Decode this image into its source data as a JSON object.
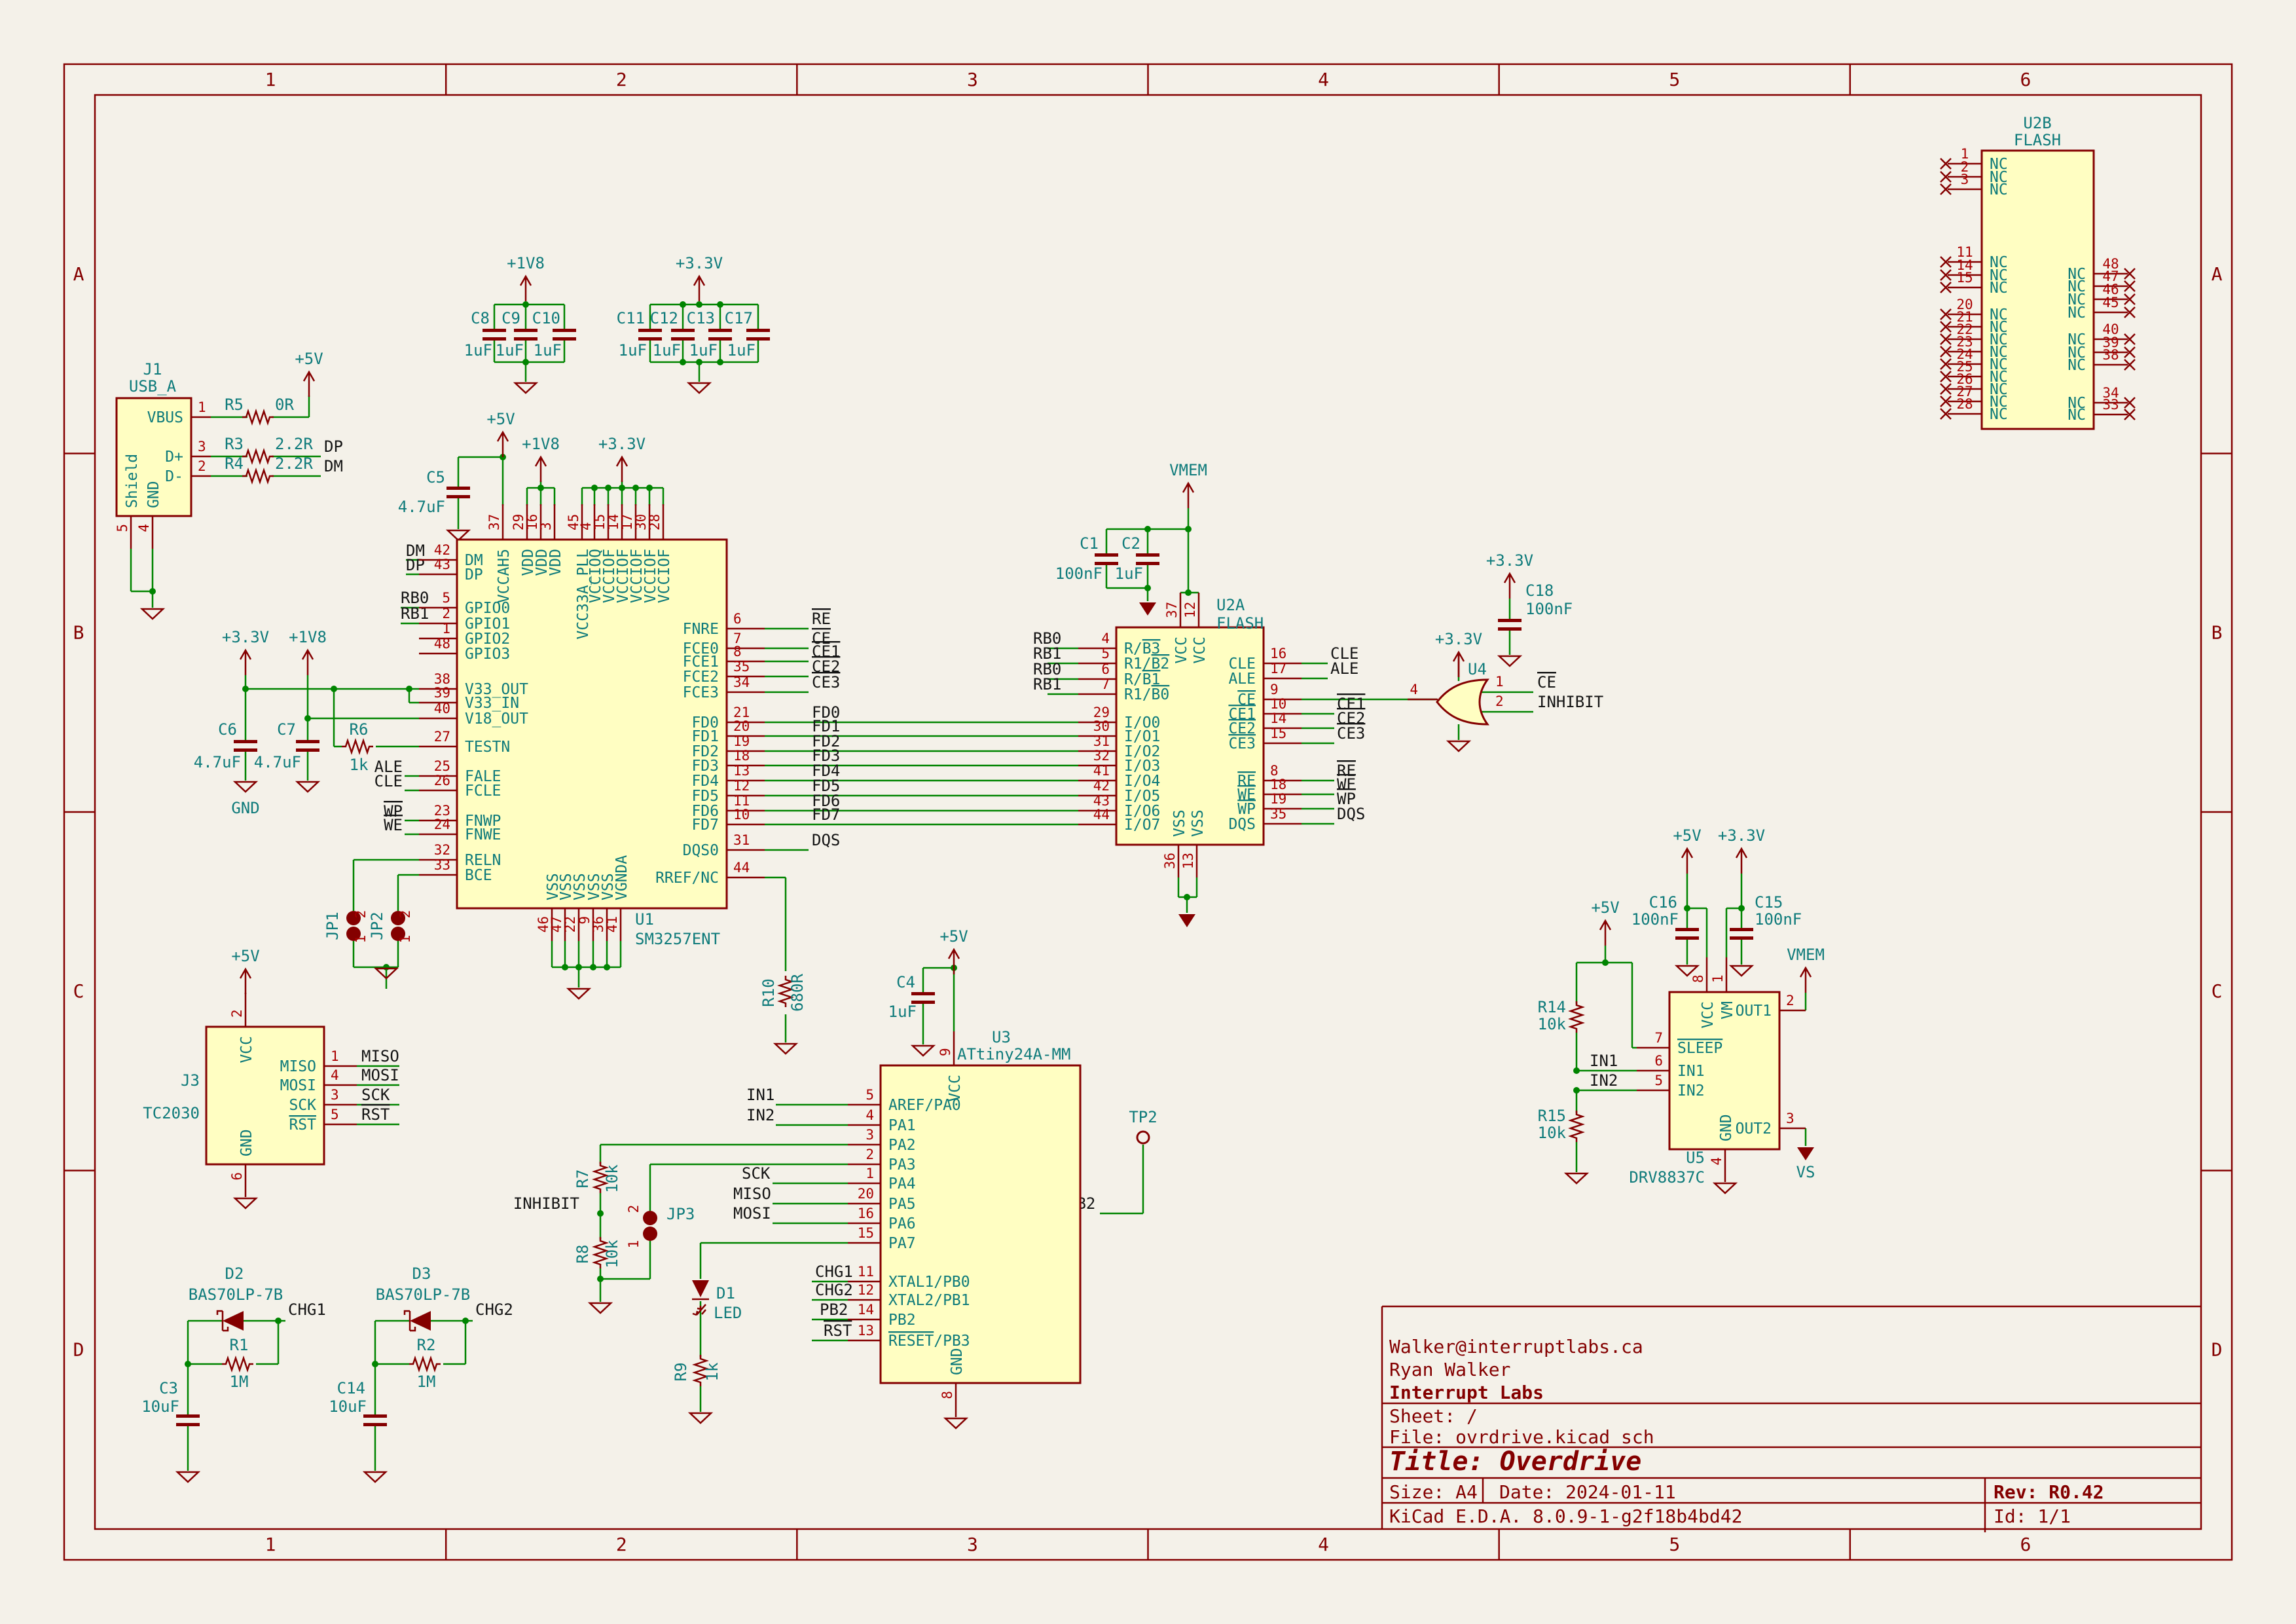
{
  "sheet": {
    "cols": [
      "1",
      "2",
      "3",
      "4",
      "5",
      "6"
    ],
    "rows": [
      "A",
      "B",
      "C",
      "D"
    ]
  },
  "title_block": {
    "email": "Walker@interruptlabs.ca",
    "author": "Ryan Walker",
    "company": "Interrupt Labs",
    "sheet_label": "Sheet: /",
    "file_label": "File: ovrdrive.kicad_sch",
    "title_label": "Title: Overdrive",
    "size_label": "Size: A4",
    "date_label": "Date: 2024-01-11",
    "tool_label": "KiCad E.D.A. 8.0.9-1-g2f18b4bd42",
    "rev_label": "Rev: R0.42",
    "id_label": "Id: 1/1"
  },
  "power": {
    "p5v": "+5V",
    "p1v8": "+1V8",
    "p3v3": "+3.3V",
    "vmem": "VMEM",
    "vs": "VS",
    "gnd": "GND"
  },
  "nets": {
    "dp": "DP",
    "dm": "DM",
    "rb0": "RB0",
    "rb1": "RB1",
    "ale": "ALE",
    "cle": "CLE",
    "wp": "WP",
    "we": "WE",
    "re": "RE",
    "ce": "CE",
    "ce1": "CE1",
    "ce2": "CE2",
    "ce3": "CE3",
    "fd0": "FD0",
    "fd1": "FD1",
    "fd2": "FD2",
    "fd3": "FD3",
    "fd4": "FD4",
    "fd5": "FD5",
    "fd6": "FD6",
    "fd7": "FD7",
    "dqs": "DQS",
    "inhibit": "INHIBIT",
    "in1": "IN1",
    "in2": "IN2",
    "sck": "SCK",
    "miso": "MISO",
    "mosi": "MOSI",
    "rst": "RST",
    "chg1": "CHG1",
    "chg2": "CHG2",
    "pb2": "PB2"
  },
  "components": {
    "U1": {
      "ref": "U1",
      "value": "SM3257ENT",
      "left": [
        [
          "42",
          "DM"
        ],
        [
          "43",
          "DP"
        ],
        [
          "5",
          "GPIO0"
        ],
        [
          "2",
          "GPIO1"
        ],
        [
          "1",
          "GPIO2"
        ],
        [
          "48",
          "GPIO3"
        ],
        [
          "38",
          "V33_OUT"
        ],
        [
          "39",
          "V33_IN"
        ],
        [
          "40",
          "V18_OUT"
        ],
        [
          "27",
          "TESTN"
        ],
        [
          "25",
          "FALE"
        ],
        [
          "26",
          "FCLE"
        ],
        [
          "23",
          "FNWP"
        ],
        [
          "24",
          "FNWE"
        ],
        [
          "32",
          "RELN"
        ],
        [
          "33",
          "BCE"
        ]
      ],
      "right": [
        [
          "6",
          "FNRE"
        ],
        [
          "7",
          "FCE0"
        ],
        [
          "8",
          "FCE1"
        ],
        [
          "35",
          "FCE2"
        ],
        [
          "34",
          "FCE3"
        ],
        [
          "21",
          "FD0"
        ],
        [
          "20",
          "FD1"
        ],
        [
          "19",
          "FD2"
        ],
        [
          "18",
          "FD3"
        ],
        [
          "13",
          "FD4"
        ],
        [
          "12",
          "FD5"
        ],
        [
          "11",
          "FD6"
        ],
        [
          "10",
          "FD7"
        ],
        [
          "31",
          "DQS0"
        ],
        [
          "44",
          "RREF/NC"
        ]
      ],
      "top": [
        [
          "37",
          "VCCAH5"
        ],
        [
          "29",
          "VDD"
        ],
        [
          "16",
          "VDD"
        ],
        [
          "3",
          "VDD"
        ],
        [
          "45",
          "VCC33A_PLL"
        ],
        [
          "4",
          "VCCIOQ"
        ],
        [
          "15",
          "VCCIOF"
        ],
        [
          "14",
          "VCCIOF"
        ],
        [
          "17",
          "VCCIOF"
        ],
        [
          "30",
          "VCCIOF"
        ],
        [
          "28",
          "VCCIOF"
        ]
      ],
      "bottom": [
        [
          "46",
          "VSS"
        ],
        [
          "47",
          "VSS"
        ],
        [
          "22",
          "VSS"
        ],
        [
          "9",
          "VSS"
        ],
        [
          "36",
          "VSS"
        ],
        [
          "41",
          "VGNDA"
        ]
      ]
    },
    "U2A": {
      "ref": "U2A",
      "value": "FLASH",
      "left": [
        [
          "4",
          "R/~B3~"
        ],
        [
          "5",
          "R1/~B2~"
        ],
        [
          "6",
          "R/~B1~"
        ],
        [
          "7",
          "R1/~B0~"
        ],
        [
          "29",
          "I/O0"
        ],
        [
          "30",
          "I/O1"
        ],
        [
          "31",
          "I/O2"
        ],
        [
          "32",
          "I/O3"
        ],
        [
          "41",
          "I/O4"
        ],
        [
          "42",
          "I/O5"
        ],
        [
          "43",
          "I/O6"
        ],
        [
          "44",
          "I/O7"
        ]
      ],
      "right": [
        [
          "16",
          "CLE"
        ],
        [
          "17",
          "ALE"
        ],
        [
          "9",
          "~CE~"
        ],
        [
          "10",
          "~CE1~"
        ],
        [
          "14",
          "~CE2~"
        ],
        [
          "15",
          "~CE3~"
        ],
        [
          "8",
          "~RE~"
        ],
        [
          "18",
          "~WE~"
        ],
        [
          "19",
          "~WP~"
        ],
        [
          "35",
          "DQS"
        ]
      ],
      "top": [
        [
          "37",
          "VCC"
        ],
        [
          "12",
          "VCC"
        ]
      ],
      "bottom": [
        [
          "36",
          "VSS"
        ],
        [
          "13",
          "VSS"
        ]
      ]
    },
    "U2B": {
      "ref": "U2B",
      "value": "FLASH",
      "left": [
        [
          "1",
          "NC"
        ],
        [
          "2",
          "NC"
        ],
        [
          "3",
          "NC"
        ],
        [
          "11",
          "NC"
        ],
        [
          "14",
          "NC"
        ],
        [
          "15",
          "NC"
        ],
        [
          "20",
          "NC"
        ],
        [
          "21",
          "NC"
        ],
        [
          "22",
          "NC"
        ],
        [
          "23",
          "NC"
        ],
        [
          "24",
          "NC"
        ],
        [
          "25",
          "NC"
        ],
        [
          "26",
          "NC"
        ],
        [
          "27",
          "NC"
        ],
        [
          "28",
          "NC"
        ]
      ],
      "right": [
        [
          "48",
          "NC"
        ],
        [
          "47",
          "NC"
        ],
        [
          "46",
          "NC"
        ],
        [
          "45",
          "NC"
        ],
        [
          "40",
          "NC"
        ],
        [
          "39",
          "NC"
        ],
        [
          "38",
          "NC"
        ],
        [
          "34",
          "NC"
        ],
        [
          "33",
          "NC"
        ]
      ]
    },
    "U3": {
      "ref": "U3",
      "value": "ATtiny24A-MM",
      "left": [
        [
          "5",
          "AREF/PA0"
        ],
        [
          "4",
          "PA1"
        ],
        [
          "3",
          "PA2"
        ],
        [
          "2",
          "PA3"
        ],
        [
          "1",
          "PA4"
        ],
        [
          "20",
          "PA5"
        ],
        [
          "16",
          "PA6"
        ],
        [
          "15",
          "PA7"
        ],
        [
          "11",
          "XTAL1/PB0"
        ],
        [
          "12",
          "XTAL2/PB1"
        ],
        [
          "14",
          "PB2"
        ],
        [
          "13",
          "~RESET~/PB3"
        ]
      ],
      "top": [
        [
          "9",
          "VCC"
        ]
      ],
      "bottom": [
        [
          "8",
          "GND"
        ]
      ]
    },
    "U4": {
      "ref": "U4",
      "pins": {
        "out": "4",
        "in1": "1",
        "in2": "2"
      }
    },
    "U5": {
      "ref": "U5",
      "value": "DRV8837C",
      "left": [
        [
          "7",
          "~SLEEP~"
        ],
        [
          "6",
          "IN1"
        ],
        [
          "5",
          "IN2"
        ]
      ],
      "right": [
        [
          "2",
          "OUT1"
        ],
        [
          "3",
          "OUT2"
        ]
      ],
      "top": [
        [
          "8",
          "VCC"
        ],
        [
          "1",
          "VM"
        ]
      ],
      "bottom": [
        [
          "4",
          "GND"
        ]
      ]
    },
    "J1": {
      "ref": "J1",
      "value": "USB_A",
      "right": [
        [
          "1",
          "VBUS"
        ],
        [
          "3",
          "D+"
        ],
        [
          "2",
          "D-"
        ]
      ],
      "bottom": [
        [
          "5",
          "Shield"
        ],
        [
          "4",
          "GND"
        ]
      ]
    },
    "J3": {
      "ref": "J3",
      "value": "TC2030",
      "right": [
        [
          "1",
          "MISO"
        ],
        [
          "4",
          "MOSI"
        ],
        [
          "3",
          "SCK"
        ],
        [
          "5",
          "~RST~"
        ]
      ],
      "top": [
        [
          "2",
          "VCC"
        ]
      ],
      "bottom": [
        [
          "6",
          "GND"
        ]
      ]
    },
    "R1": {
      "ref": "R1",
      "value": "1M"
    },
    "R2": {
      "ref": "R2",
      "value": "1M"
    },
    "R3": {
      "ref": "R3",
      "value": "2.2R"
    },
    "R4": {
      "ref": "R4",
      "value": "2.2R"
    },
    "R5": {
      "ref": "R5",
      "value": "0R"
    },
    "R6": {
      "ref": "R6",
      "value": "1k"
    },
    "R7": {
      "ref": "R7",
      "value": "10k"
    },
    "R8": {
      "ref": "R8",
      "value": "10k"
    },
    "R9": {
      "ref": "R9",
      "value": "1k"
    },
    "R10": {
      "ref": "R10",
      "value": "680R"
    },
    "R14": {
      "ref": "R14",
      "value": "10k"
    },
    "R15": {
      "ref": "R15",
      "value": "10k"
    },
    "C1": {
      "ref": "C1",
      "value": "100nF"
    },
    "C2": {
      "ref": "C2",
      "value": "1uF"
    },
    "C3": {
      "ref": "C3",
      "value": "10uF"
    },
    "C4": {
      "ref": "C4",
      "value": "1uF"
    },
    "C5": {
      "ref": "C5",
      "value": "4.7uF"
    },
    "C6": {
      "ref": "C6",
      "value": "4.7uF"
    },
    "C7": {
      "ref": "C7",
      "value": "4.7uF"
    },
    "C8": {
      "ref": "C8",
      "value": "1uF"
    },
    "C9": {
      "ref": "C9",
      "value": "1uF"
    },
    "C10": {
      "ref": "C10",
      "value": "1uF"
    },
    "C11": {
      "ref": "C11",
      "value": "1uF"
    },
    "C12": {
      "ref": "C12",
      "value": "1uF"
    },
    "C13": {
      "ref": "C13",
      "value": "1uF"
    },
    "C14": {
      "ref": "C14",
      "value": "10uF"
    },
    "C15": {
      "ref": "C15",
      "value": "100nF"
    },
    "C16": {
      "ref": "C16",
      "value": "100nF"
    },
    "C17": {
      "ref": "C17",
      "value": "1uF"
    },
    "C18": {
      "ref": "C18",
      "value": "100nF"
    },
    "D1": {
      "ref": "D1",
      "value": "LED"
    },
    "D2": {
      "ref": "D2",
      "value": "BAS70LP-7B"
    },
    "D3": {
      "ref": "D3",
      "value": "BAS70LP-7B"
    },
    "JP1": {
      "ref": "JP1"
    },
    "JP2": {
      "ref": "JP2"
    },
    "JP3": {
      "ref": "JP3"
    },
    "TP2": {
      "ref": "TP2"
    }
  }
}
